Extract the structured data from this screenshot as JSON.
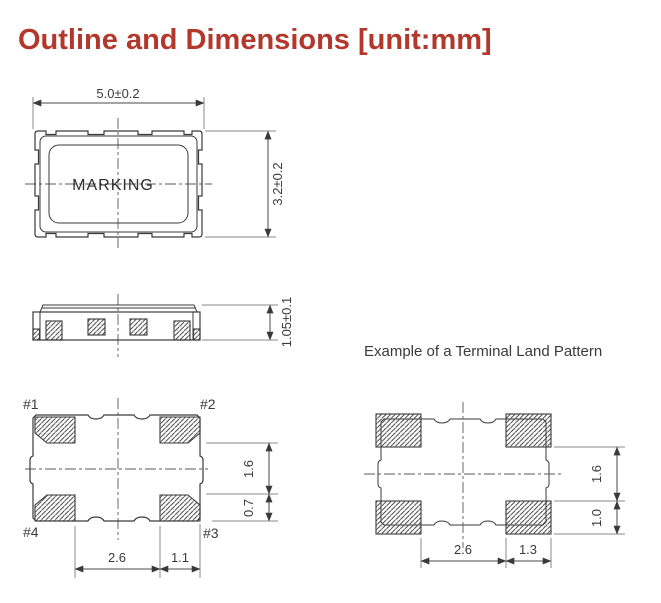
{
  "page_title": "Outline and Dimensions [unit:mm]",
  "top_view": {
    "width_dim": "5.0±0.2",
    "height_dim": "3.2±0.2",
    "marking": "MARKING"
  },
  "side_view": {
    "height_dim": "1.05±0.1"
  },
  "bottom_view": {
    "pad_labels": [
      "#1",
      "#2",
      "#3",
      "#4"
    ],
    "pad_span_dim": "2.6",
    "pad_width_dim": "1.1",
    "right_upper_dim": "1.6",
    "right_lower_dim": "0.7"
  },
  "land_pattern": {
    "title": "Example of a Terminal Land Pattern",
    "pad_span_dim": "2.6",
    "pad_width_dim": "1.3",
    "right_upper_dim": "1.6",
    "right_lower_dim": "1.0"
  },
  "colors": {
    "accent": "#b2382c",
    "line": "#3a3a3a",
    "dim_line": "#4a4a4a",
    "extension_line": "#8a8a8a"
  }
}
